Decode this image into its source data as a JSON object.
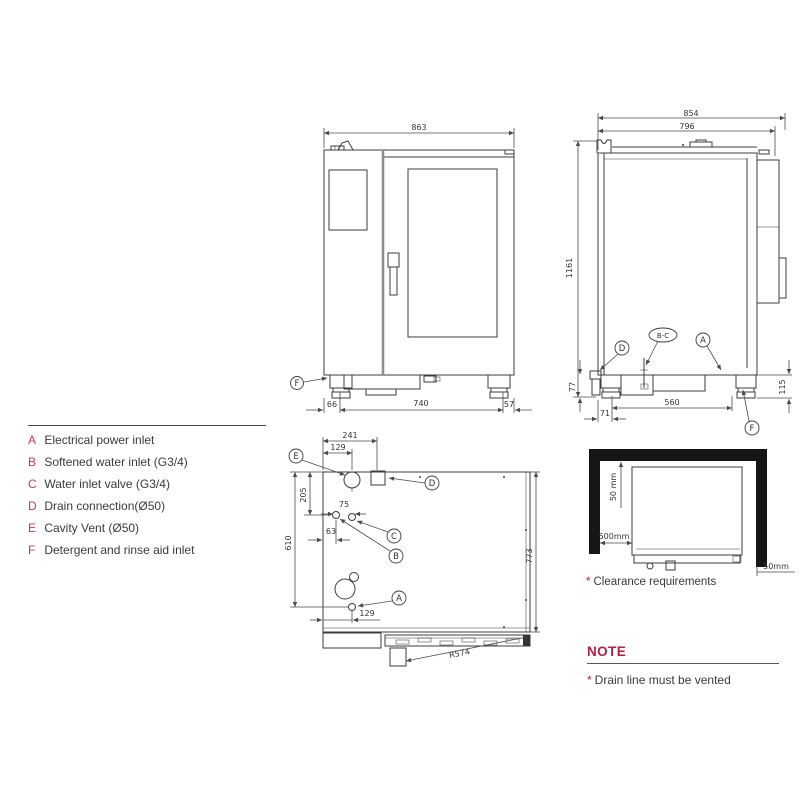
{
  "drawing": {
    "marks": {
      "a": "A",
      "b": "B",
      "c": "C",
      "d": "D",
      "e": "E",
      "f": "F",
      "bc": "B-C"
    },
    "front": {
      "overall_width": "863",
      "left_offset": "66",
      "base_width": "740",
      "right_offset": "57"
    },
    "side": {
      "overall_depth": "854",
      "body_depth": "796",
      "overall_height": "1161",
      "leg_height": "77",
      "back_offset": "71",
      "base_depth": "560",
      "base_height": "115"
    },
    "top": {
      "drain_offset": "241",
      "vent_offset": "129",
      "vent_depth": "205",
      "inlet_spacing": "75",
      "inlet_offset": "63",
      "power_depth": "610",
      "power_offset": "129",
      "overall_depth": "773",
      "door_swing_radius": "R574"
    }
  },
  "legend": {
    "items": [
      {
        "key": "A",
        "label": "Electrical power inlet"
      },
      {
        "key": "B",
        "label": "Softened water inlet (G3/4)"
      },
      {
        "key": "C",
        "label": "Water inlet valve (G3/4)"
      },
      {
        "key": "D",
        "label": "Drain connection(Ø50)"
      },
      {
        "key": "E",
        "label": "Cavity Vent (Ø50)"
      },
      {
        "key": "F",
        "label": "Detergent and rinse aid inlet"
      }
    ]
  },
  "clearance": {
    "top_gap": "50 mm",
    "left_gap": "500mm",
    "right_gap": "50mm",
    "caption_mark": "*",
    "caption": "Clearance requirements"
  },
  "note": {
    "title": "NOTE",
    "mark": "*",
    "text": "Drain line must be vented"
  },
  "colors": {
    "accent": "#c41e3d",
    "line": "#3c3c3c",
    "wall": "#161616"
  }
}
